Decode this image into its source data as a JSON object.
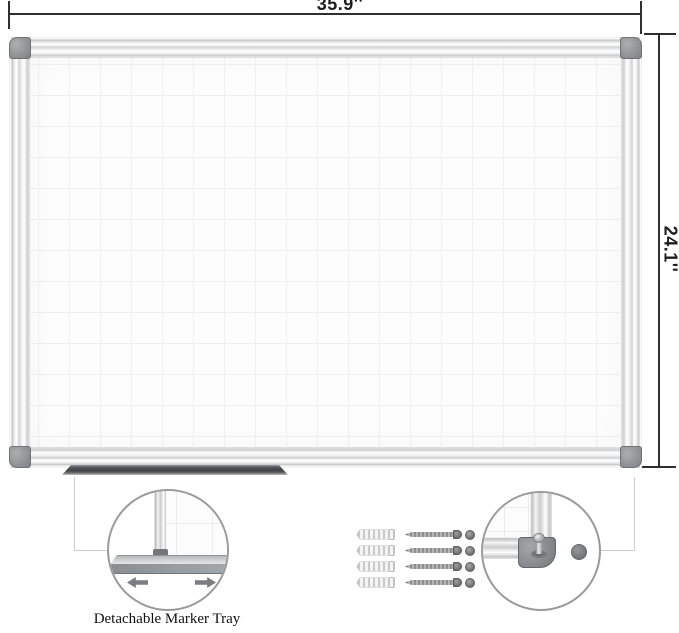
{
  "figure": {
    "width_label": "35.9''",
    "height_label": "24.1''"
  },
  "callouts": {
    "tray": {
      "caption": "Detachable Marker Tray"
    },
    "corner": {
      "contents": "frame corner with locking pin and magnet dot"
    }
  },
  "hardware": {
    "wall_anchor_count": 4,
    "screw_count": 4,
    "cap_count": 4,
    "magnet_count": 1
  },
  "icons": {
    "slide_left_arrow": "left-pointing block arrow",
    "slide_right_arrow": "right-pointing block arrow"
  },
  "colors": {
    "dim_line": "#2f2f2f",
    "dim_text": "#1d1d1d",
    "callout_line": "#cccccc",
    "circle_border": "#9a9a9a",
    "caption_text": "#111111",
    "surface": "#fcfcfc",
    "grid": "#f0f0f0",
    "corner_gray": "#6f7376",
    "tray_dark": "#3f4346",
    "arrow_gray": "#7a7e82",
    "screw_gray": "#8f8f8f",
    "screw_head_gray": "#5f5f5f",
    "cap_gray": "#6d6d6d",
    "magnet_gray": "#6e7174"
  }
}
